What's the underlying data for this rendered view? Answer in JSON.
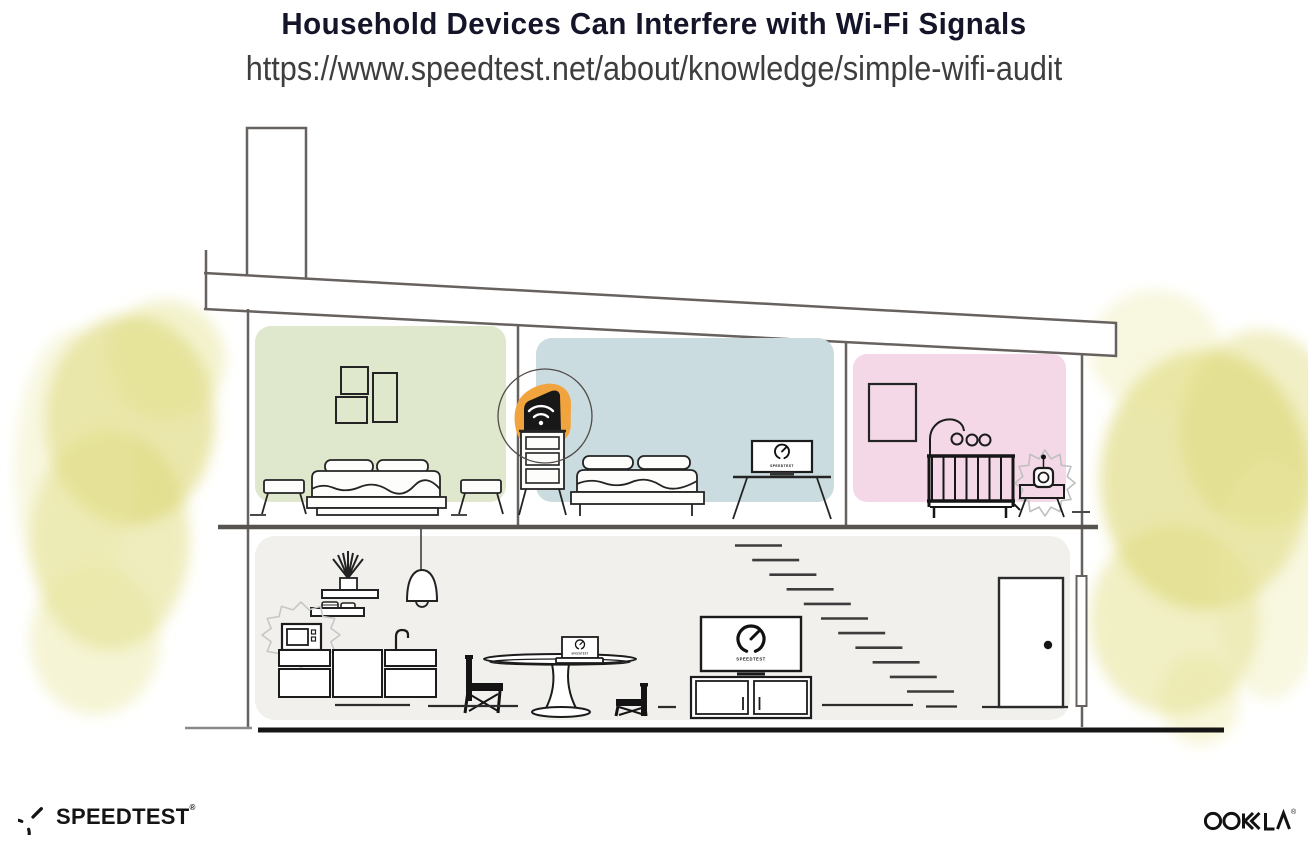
{
  "header": {
    "title": "Household Devices Can Interfere with Wi-Fi Signals",
    "url": "https://www.speedtest.net/about/knowledge/simple-wifi-audit"
  },
  "illustration": {
    "alt": "Cross-section of a two-story house showing household devices (microwave, baby monitor, TVs, laptops) around a Wi-Fi router",
    "rooms": [
      {
        "name": "left-bedroom",
        "color": "#dfe8cc"
      },
      {
        "name": "middle-bedroom",
        "color": "#cbdce1"
      },
      {
        "name": "nursery",
        "color": "#f4d8e7"
      },
      {
        "name": "living-area",
        "color": "#f1f0ed"
      }
    ],
    "router_highlight_color": "#f1a43e",
    "screen_label": "SPEEDTEST"
  },
  "footer": {
    "speedtest_wordmark": "SPEEDTEST",
    "speedtest_reg_mark": "®",
    "ookla_wordmark": "OOKLA",
    "ookla_reg_mark": "®"
  }
}
